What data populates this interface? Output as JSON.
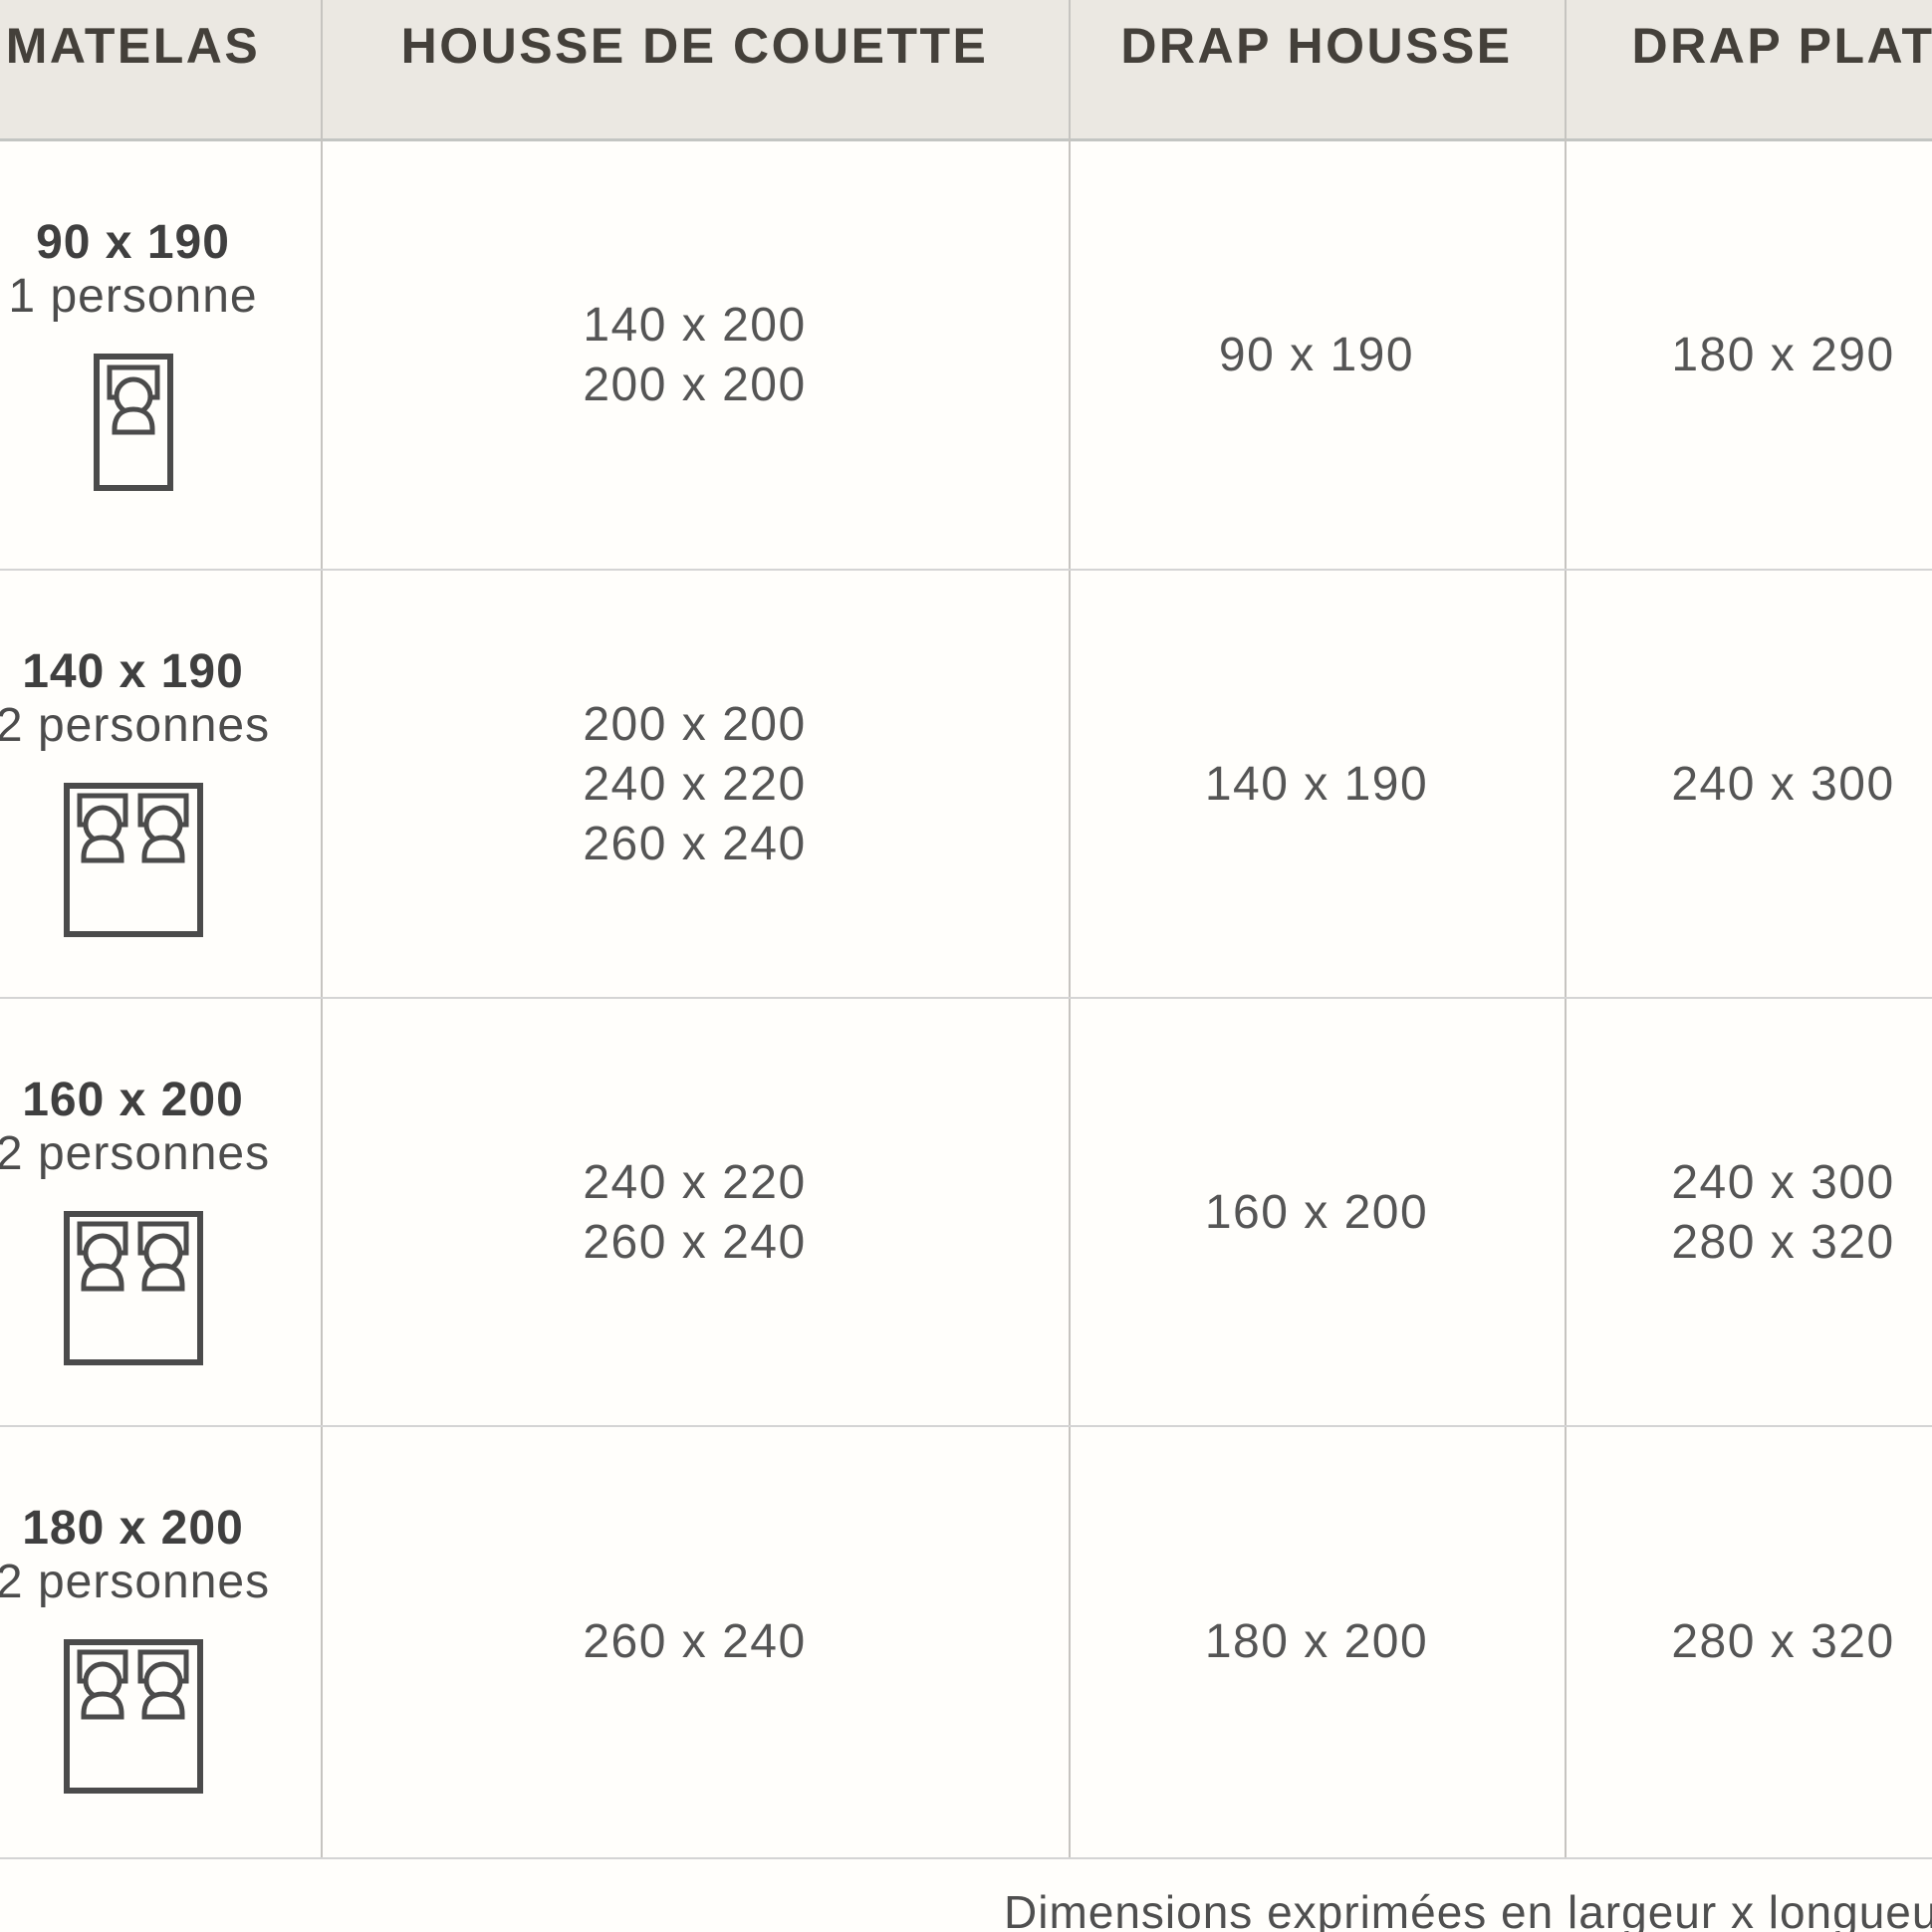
{
  "chart_data": {
    "type": "table",
    "columns": [
      "MATELAS",
      "HOUSSE DE COUETTE",
      "DRAP HOUSSE",
      "DRAP PLAT"
    ],
    "rows": [
      {
        "matelas_size": "90 x 190",
        "matelas_capacity": "1 personne",
        "bed_icon": "single",
        "housse_de_couette": [
          "140 x 200",
          "200 x 200"
        ],
        "drap_housse": [
          "90 x 190"
        ],
        "drap_plat": [
          "180 x 290"
        ]
      },
      {
        "matelas_size": "140 x 190",
        "matelas_capacity": "2 personnes",
        "bed_icon": "double",
        "housse_de_couette": [
          "200 x 200",
          "240 x 220",
          "260 x 240"
        ],
        "drap_housse": [
          "140 x 190"
        ],
        "drap_plat": [
          "240 x 300"
        ]
      },
      {
        "matelas_size": "160 x 200",
        "matelas_capacity": "2 personnes",
        "bed_icon": "double",
        "housse_de_couette": [
          "240 x 220",
          "260 x 240"
        ],
        "drap_housse": [
          "160 x 200"
        ],
        "drap_plat": [
          "240 x 300",
          "280 x 320"
        ]
      },
      {
        "matelas_size": "180 x 200",
        "matelas_capacity": "2 personnes",
        "bed_icon": "double",
        "housse_de_couette": [
          "260 x 240"
        ],
        "drap_housse": [
          "180 x 200"
        ],
        "drap_plat": [
          "280 x 320"
        ]
      }
    ],
    "footnote": "Dimensions exprimées en largeur x longueur (cm",
    "layout": "grid with beige header row; first column shows mattress size, capacity and bed pictogram; other cells list sizes in cm"
  },
  "colors": {
    "page_bg": "#fffefb",
    "header_bg": "#ebe8e2",
    "header_text": "#44403a",
    "body_text": "#555555",
    "label_text": "#3f3f3f",
    "grid_line": "#c6c4c0",
    "icon_stroke": "#4b4b4b"
  }
}
